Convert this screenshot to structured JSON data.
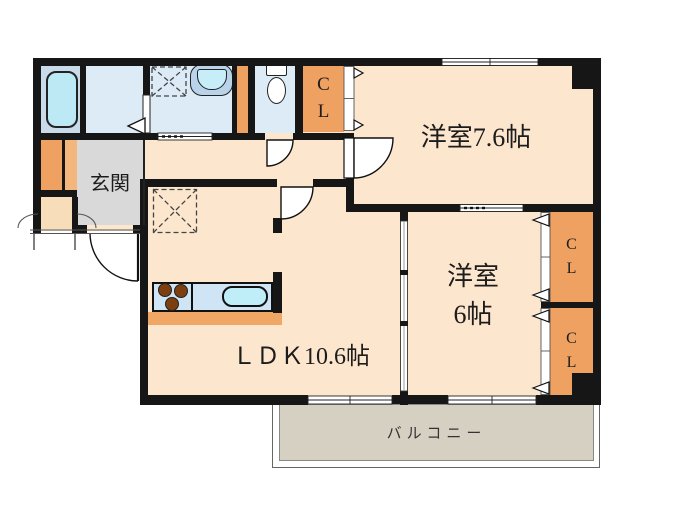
{
  "labels": {
    "room_76": "洋室7.6帖",
    "room_6_line1": "洋室",
    "room_6_line2": "6帖",
    "ldk": "ＬＤＫ10.6帖",
    "entrance": "玄関",
    "balcony": "バルコニー",
    "closet": {
      "c": "C",
      "l": "L"
    }
  },
  "colors": {
    "wall": "#161616",
    "room": "#fce6cd",
    "wet": "#dcebf5",
    "tub_area": "#c9dbe9",
    "tub": "#bce9f3",
    "closet": "#efa161",
    "shoe_light": "#f3b77e",
    "porch": "#f8ddba",
    "entrance": "#d9d9d9",
    "balcony": "#d6d0c3",
    "counter": "#cfe4f4",
    "sink": "#bfeef8",
    "kitchen_base": "#f0a766",
    "burner": "#7d3f10",
    "basin_outer": "#b9d3ea",
    "basin_inner": "#c6edf8"
  }
}
